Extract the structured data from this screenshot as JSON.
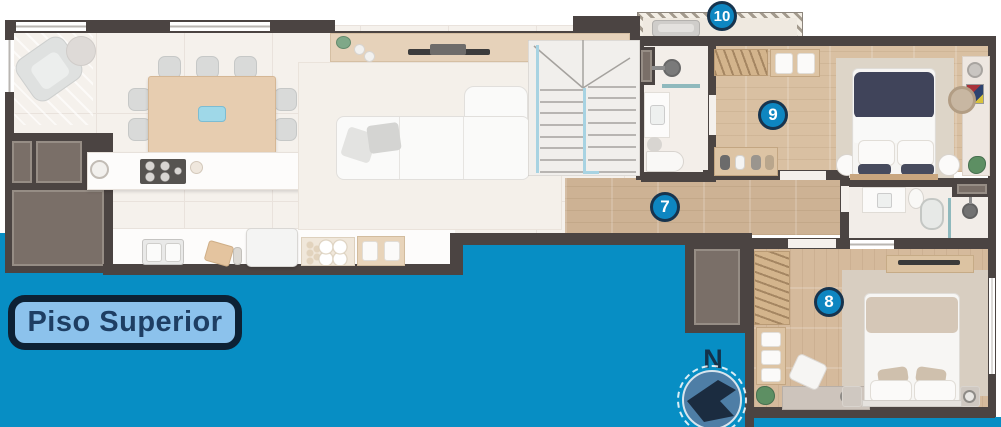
{
  "floor_label": {
    "text": "Piso Superior"
  },
  "compass": {
    "north_label": "N"
  },
  "markers": [
    {
      "label": "7"
    },
    {
      "label": "8"
    },
    {
      "label": "9"
    },
    {
      "label": "10"
    }
  ],
  "theme": {
    "void_blue": "#078ec4",
    "wall": "#4b4442",
    "wall_inner": "#7a6f68",
    "badge_fill": "#0e86c1",
    "badge_border": "#17344e",
    "badge_text": "#ffffff",
    "pill_bg": "#8cc2ec",
    "pill_border": "#0d2134",
    "pill_text": "#1e3e63",
    "compass_fill": "#4e7ea6",
    "compass_arrow": "#1b2c40",
    "compass_text": "#14324b",
    "rail": "#a8d3e2",
    "wood_hall": "#cdb294",
    "wood_bedroom": "#d9c0a2",
    "floor_ivory": "#f5f1ec",
    "rug": "#ddd5c8"
  }
}
